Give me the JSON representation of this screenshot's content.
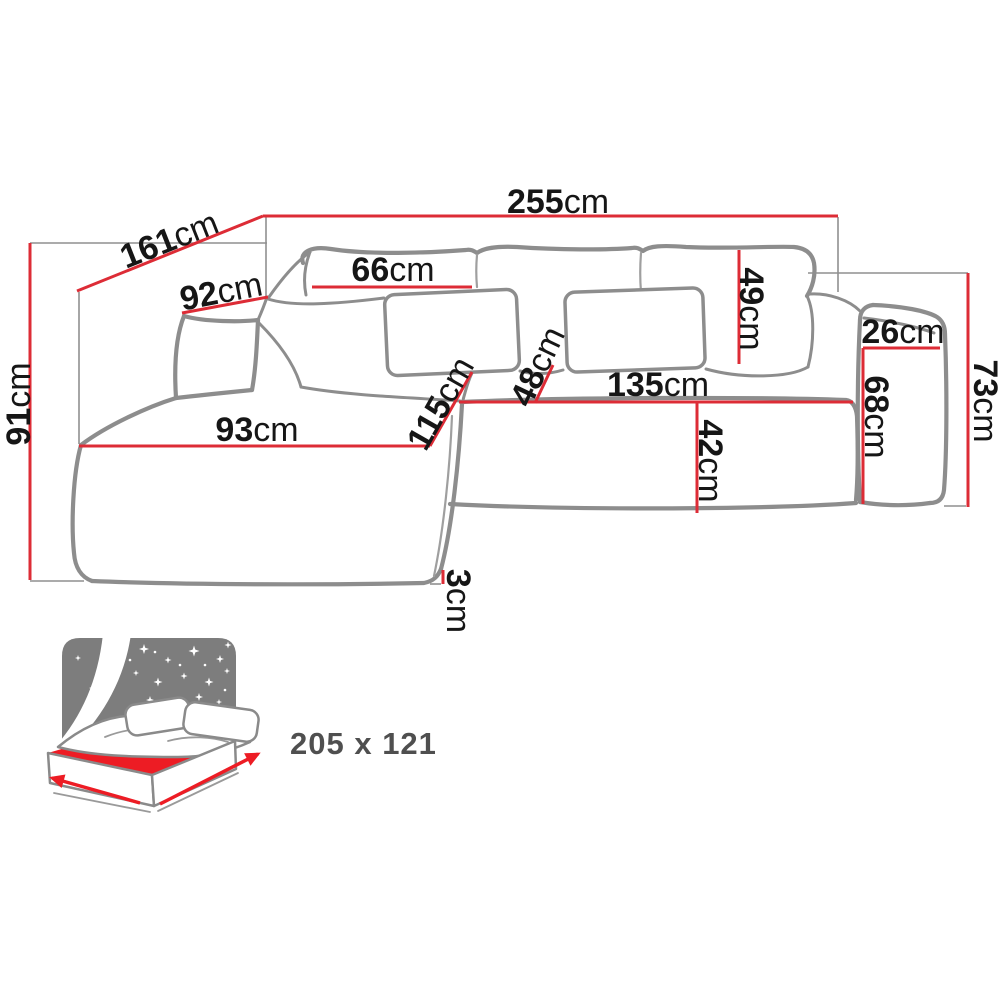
{
  "colors": {
    "dim": "#dd2c36",
    "sofa": "#8d8d8d",
    "text": "#161616",
    "icon": "#7d7d7d",
    "mattress": "#ed1c24",
    "sleep": "#4f4f4f"
  },
  "dims": {
    "total_width": {
      "v": "255",
      "u": "cm"
    },
    "total_depth": {
      "v": "161",
      "u": "cm"
    },
    "left_arm_depth": {
      "v": "92",
      "u": "cm"
    },
    "back_cushion_width": {
      "v": "66",
      "u": "cm"
    },
    "back_pillow_height": {
      "v": "49",
      "u": "cm"
    },
    "right_arm_width": {
      "v": "26",
      "u": "cm"
    },
    "right_side_height": {
      "v": "73",
      "u": "cm"
    },
    "arm_front_height": {
      "v": "68",
      "u": "cm"
    },
    "seat_width": {
      "v": "135",
      "u": "cm"
    },
    "seat_height": {
      "v": "42",
      "u": "cm"
    },
    "chaise_depth": {
      "v": "115",
      "u": "cm"
    },
    "seat_depth": {
      "v": "48",
      "u": "cm"
    },
    "chaise_width": {
      "v": "93",
      "u": "cm"
    },
    "total_height": {
      "v": "91",
      "u": "cm"
    },
    "base_clearance": {
      "v": "3",
      "u": "cm"
    }
  },
  "sleeping_area": {
    "size_label": "205 x 121",
    "icon": "sleeping-function-icon"
  }
}
